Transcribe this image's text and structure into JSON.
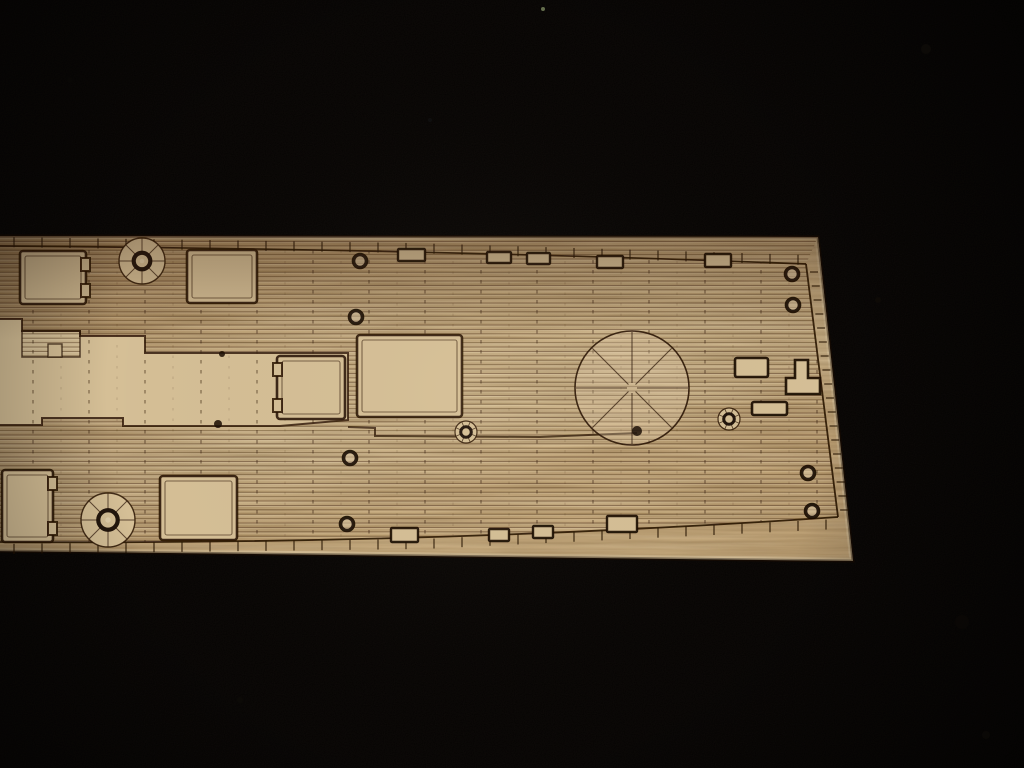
{
  "image": {
    "width": 1024,
    "height": 768,
    "subject": "laser-etched wooden model ship deck sheet lying on black velvet",
    "background_color": "#050302"
  },
  "colors": {
    "background": "#050302",
    "wood_base": "#c9ac7d",
    "wood_smooth": "#d5bf96",
    "wood_light": "#e3d2ae",
    "etch": "#2a1404",
    "etch_dark": "#1a0d04",
    "plank_line": "rgba(70,42,16,0.5)",
    "plank_highlight": "rgba(255,243,214,0.18)",
    "edge_light": "#ead9b6",
    "char_edge": "#140a03",
    "tick": "rgba(40,22,8,0.8)",
    "column": "rgba(55,32,12,0.55)"
  },
  "wood": {
    "polygon": [
      [
        -6,
        236
      ],
      [
        818,
        237
      ],
      [
        853,
        561
      ],
      [
        -6,
        551
      ]
    ],
    "gradient": [
      [
        "0%",
        "#b89a6d"
      ],
      [
        "18%",
        "#c3a578"
      ],
      [
        "48%",
        "#d1b78b"
      ],
      [
        "78%",
        "#d7c096"
      ],
      [
        "100%",
        "#cdb184"
      ]
    ]
  },
  "deck": {
    "outline_top_path": "M0,246 Q420,249 806,264",
    "outline_top_pts": [
      [
        0,
        246
      ],
      [
        411,
        252
      ],
      [
        806,
        264
      ]
    ],
    "outline_right_pts": [
      [
        806,
        264
      ],
      [
        838,
        517
      ]
    ],
    "outline_bottom_path": "M838,517 Q430,545 0,542",
    "outline_bottom_pts": [
      [
        0,
        542
      ],
      [
        424,
        537
      ],
      [
        838,
        517
      ]
    ],
    "deck_clip": "M0,246 Q420,249 806,264 L838,517 Q430,545 0,542 Z",
    "plank_region": "M-6,236 L818,237 L806,264 L838,517 Q430,545 0,542 L-6,542 Z",
    "plank_spacing": 4.4,
    "smooth_band": [
      [
        -6,
        319
      ],
      [
        22,
        319
      ],
      [
        22,
        331
      ],
      [
        80,
        331
      ],
      [
        80,
        336
      ],
      [
        145,
        336
      ],
      [
        145,
        353
      ],
      [
        348,
        353
      ],
      [
        348,
        420
      ],
      [
        280,
        426
      ],
      [
        123,
        426
      ],
      [
        123,
        418
      ],
      [
        42,
        418
      ],
      [
        42,
        425
      ],
      [
        -6,
        425
      ]
    ],
    "planked_patch": [
      22,
      331,
      58,
      26
    ],
    "smooth_tab": [
      48,
      344,
      14,
      13
    ],
    "step_line": [
      [
        348,
        427
      ],
      [
        375,
        428
      ],
      [
        375,
        436
      ],
      [
        540,
        437
      ],
      [
        637,
        433
      ]
    ],
    "ticks": {
      "top": {
        "x0": 14,
        "x1": 798,
        "step": 28,
        "len": 9
      },
      "bottom": {
        "x0": 14,
        "x1": 840,
        "step": 28,
        "len": 10
      },
      "right": {
        "y0": 272,
        "y1": 512,
        "step": 14,
        "len": 8
      }
    },
    "butt_columns": {
      "x0": 33,
      "step": 56,
      "count": 15,
      "minor_offset": 28,
      "y0": 240,
      "y1": 546
    }
  },
  "features": {
    "hatches": [
      {
        "name": "hatch-fore-left",
        "x": 20,
        "y": 251,
        "w": 66,
        "h": 53,
        "notch": "right"
      },
      {
        "name": "hatch-fore-mid",
        "x": 187,
        "y": 250,
        "w": 70,
        "h": 53,
        "notch": ""
      },
      {
        "name": "hatch-mid-left",
        "x": 277,
        "y": 356,
        "w": 68,
        "h": 63,
        "notch": "left"
      },
      {
        "name": "hatch-main",
        "x": 357,
        "y": 335,
        "w": 105,
        "h": 82,
        "notch": ""
      },
      {
        "name": "hatch-aft-left",
        "x": 2,
        "y": 470,
        "w": 51,
        "h": 72,
        "notch": "right"
      },
      {
        "name": "hatch-aft-mid",
        "x": 160,
        "y": 476,
        "w": 77,
        "h": 64,
        "notch": ""
      }
    ],
    "capstans": [
      {
        "name": "capstan-fore",
        "cx": 142,
        "cy": 261,
        "r": 23
      },
      {
        "name": "capstan-aft",
        "cx": 108,
        "cy": 520,
        "r": 27
      }
    ],
    "small_wheels": [
      {
        "name": "winch-small-mid",
        "cx": 466,
        "cy": 432,
        "r": 11
      },
      {
        "name": "winch-small-right",
        "cx": 729,
        "cy": 419,
        "r": 11
      }
    ],
    "barbette": {
      "cx": 632,
      "cy": 388,
      "r": 57,
      "spokes": 8
    },
    "bolt_rings": [
      [
        360,
        261
      ],
      [
        356,
        317
      ],
      [
        350,
        458
      ],
      [
        347,
        524
      ],
      [
        792,
        274
      ],
      [
        793,
        305
      ],
      [
        808,
        473
      ],
      [
        812,
        511
      ]
    ],
    "chocks": [
      [
        398,
        249,
        27,
        12
      ],
      [
        487,
        252,
        24,
        11
      ],
      [
        527,
        253,
        23,
        11
      ],
      [
        597,
        256,
        26,
        12
      ],
      [
        705,
        254,
        26,
        13
      ],
      [
        391,
        528,
        27,
        14
      ],
      [
        489,
        529,
        20,
        12
      ],
      [
        533,
        526,
        20,
        12
      ],
      [
        607,
        516,
        30,
        16
      ]
    ],
    "fitting_rects": [
      [
        735,
        358,
        33,
        19
      ],
      [
        752,
        402,
        35,
        13
      ]
    ],
    "fitting_tee": "M795,360 L808,360 L808,378 L820,378 L820,394 L786,394 L786,378 L795,378 Z",
    "burn_spots": [
      [
        218,
        424,
        4
      ],
      [
        637,
        431,
        5
      ],
      [
        222,
        354,
        3
      ]
    ]
  },
  "background_specks": [
    [
      543,
      9,
      2,
      "#7f8d63"
    ],
    [
      926,
      49,
      5,
      "#17120d"
    ],
    [
      986,
      735,
      4,
      "#15100b"
    ],
    [
      70,
      80,
      3,
      "#0d0a07"
    ],
    [
      240,
      700,
      3,
      "#0e0b08"
    ],
    [
      878,
      300,
      3,
      "#100c08"
    ],
    [
      962,
      622,
      7,
      "#0f0b07"
    ],
    [
      430,
      120,
      2,
      "#101010"
    ]
  ]
}
